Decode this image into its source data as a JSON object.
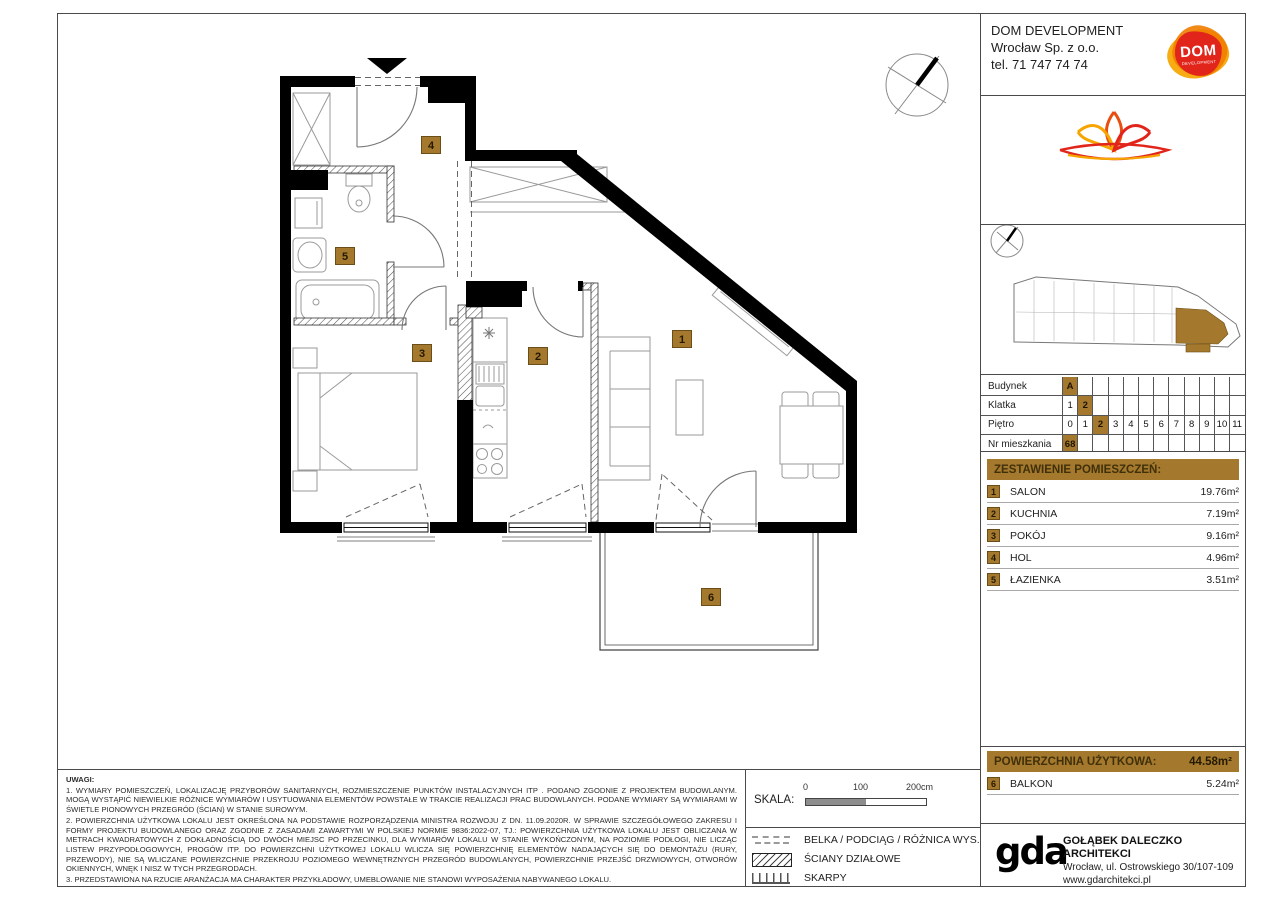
{
  "colors": {
    "accent": "#a5792d",
    "accent_dark": "#6b4e17",
    "logo_red": "#e1251b",
    "logo_orange": "#f6a500"
  },
  "developer": {
    "name": "DOM DEVELOPMENT",
    "company": "Wrocław Sp. z o.o.",
    "phone": "tel. 71 747 74 74",
    "logo_text": "DOM",
    "logo_subtext": "DEVELOPMENT"
  },
  "brand": {
    "line1": "APARTAMENTY",
    "line2": "NAD OŁAWKĄ"
  },
  "unit_table": {
    "rows": [
      {
        "label": "Budynek",
        "cells": [
          "A"
        ],
        "highlighted": [
          "A"
        ],
        "slots": 12
      },
      {
        "label": "Klatka",
        "cells": [
          "1",
          "2"
        ],
        "highlighted": [
          "2"
        ],
        "slots": 12
      },
      {
        "label": "Piętro",
        "cells": [
          "0",
          "1",
          "2",
          "3",
          "4",
          "5",
          "6",
          "7",
          "8",
          "9",
          "10",
          "11"
        ],
        "highlighted": [
          "2"
        ],
        "slots": 12
      },
      {
        "label": "Nr mieszkania",
        "cells": [
          "68"
        ],
        "highlighted": [
          "68"
        ],
        "slots": 12
      }
    ]
  },
  "rooms_section": {
    "title": "ZESTAWIENIE POMIESZCZEŃ:",
    "rooms": [
      {
        "no": "1",
        "name": "SALON",
        "area": "19.76m²"
      },
      {
        "no": "2",
        "name": "KUCHNIA",
        "area": "7.19m²"
      },
      {
        "no": "3",
        "name": "POKÓJ",
        "area": "9.16m²"
      },
      {
        "no": "4",
        "name": "HOL",
        "area": "4.96m²"
      },
      {
        "no": "5",
        "name": "ŁAZIENKA",
        "area": "3.51m²"
      }
    ]
  },
  "area_section": {
    "label": "POWIERZCHNIA UŻYTKOWA:",
    "value": "44.58m²",
    "balkon": {
      "no": "6",
      "name": "BALKON",
      "area": "5.24m²"
    }
  },
  "scale": {
    "label": "SKALA:",
    "ticks": [
      "0",
      "100",
      "200cm"
    ]
  },
  "legend": {
    "items": [
      {
        "symbol": "dashed-line",
        "label": "BELKA / PODCIĄG / RÓŻNICA WYS."
      },
      {
        "symbol": "hatched-wall",
        "label": "ŚCIANY DZIAŁOWE"
      },
      {
        "symbol": "slope-ticks",
        "label": "SKARPY"
      }
    ]
  },
  "notes": {
    "title": "UWAGI:",
    "items": [
      "1. WYMIARY POMIESZCZEŃ, LOKALIZACJĘ PRZYBORÓW SANITARNYCH, ROZMIESZCZENIE PUNKTÓW INSTALACYJNYCH ITP . PODANO ZGODNIE Z PROJEKTEM BUDOWLANYM. MOGĄ WYSTĄPIĆ NIEWIELKIE RÓŻNICE WYMIARÓW I USYTUOWANIA ELEMENTÓW POWSTAŁE W TRAKCIE REALIZACJI PRAC BUDOWLANYCH. PODANE WYMIARY SĄ WYMIARAMI W ŚWIETLE PIONOWYCH PRZEGRÓD (ŚCIAN) W STANIE SUROWYM.",
      "2. POWIERZCHNIA UŻYTKOWA LOKALU JEST OKREŚLONA NA PODSTAWIE ROZPORZĄDZENIA MINISTRA ROZWOJU Z DN. 11.09.2020R. W SPRAWIE SZCZEGÓŁOWEGO ZAKRESU I FORMY PROJEKTU BUDOWLANEGO ORAZ ZGODNIE Z ZASADAMI ZAWARTYMI W POLSKIEJ NORMIE 9836:2022-07, TJ.: POWIERZCHNIA UŻYTKOWA LOKALU JEST OBLICZANA W METRACH KWADRATOWYCH Z DOKŁADNOŚCIĄ DO DWÓCH MIEJSC PO PRZECINKU, DLA WYMIARÓW LOKALU W STANIE WYKOŃCZONYM, NA POZIOMIE PODŁOGI, NIE LICZĄC LISTEW PRZYPODŁOGOWYCH, PROGÓW ITP. DO POWIERZCHNI UŻYTKOWEJ LOKALU WLICZA SIĘ POWIERZCHNIĘ ELEMENTÓW NADAJĄCYCH SIĘ DO DEMONTAŻU (RURY, PRZEWODY), NIE SĄ WLICZANE POWIERZCHNIE PRZEKROJU POZIOMEGO WEWNĘTRZNYCH PRZEGRÓD BUDOWLANYCH, POWIERZCHNIE PRZEJŚĆ DRZWIOWYCH, OTWORÓW OKIENNYCH, WNĘK I NISZ W TYCH PRZEGRODACH.",
      "3. PRZEDSTAWIONA NA RZUCIE ARANŻACJA MA CHARAKTER PRZYKŁADOWY, UMEBLOWANIE NIE STANOWI WYPOSAŻENIA NABYWANEGO LOKALU."
    ]
  },
  "architect": {
    "logo": "gda",
    "name": "GOŁĄBEK DALECZKO ARCHITEKCI",
    "address": "Wrocław, ul. Ostrowskiego 30/107-109",
    "website": "www.gdarchitekci.pl"
  }
}
